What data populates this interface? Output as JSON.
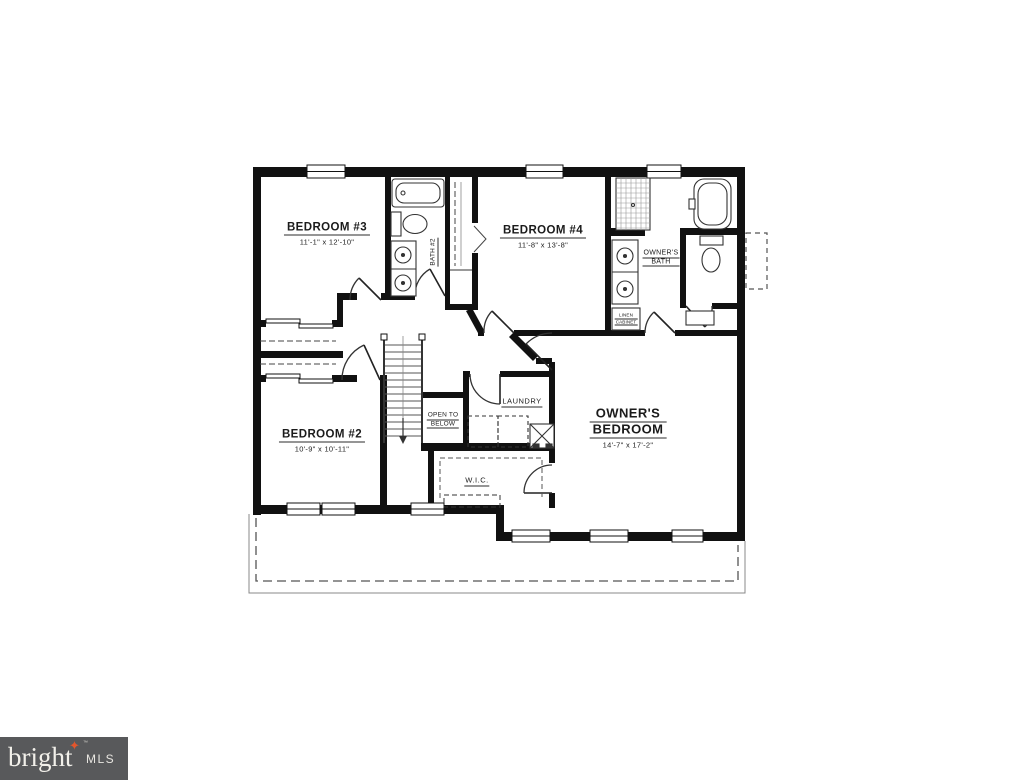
{
  "floorplan": {
    "rooms": [
      {
        "name": "BEDROOM #3",
        "dims": "11'-1\" x 12'-10\""
      },
      {
        "name": "BEDROOM #4",
        "dims": "11'-8\" x 13'-8\""
      },
      {
        "name": "BEDROOM #2",
        "dims": "10'-9\" x 10'-11\""
      },
      {
        "name_line1": "OWNER'S",
        "name_line2": "BEDROOM",
        "dims": "14'-7\" x 17'-2\""
      }
    ],
    "areas": {
      "bath2": "BATH #2",
      "owners_bath_line1": "OWNER'S",
      "owners_bath_line2": "BATH",
      "linen_line1": "LINEN",
      "linen_line2": "CABINET",
      "laundry": "LAUNDRY",
      "open_to_below_line1": "OPEN TO",
      "open_to_below_line2": "BELOW",
      "wic": "W.I.C."
    },
    "line_color": "#111111"
  },
  "logo": {
    "brand": "bright",
    "trademark": "™",
    "suffix": "MLS",
    "background": "#58595b",
    "text_color": "#f2f0ea",
    "accent_color": "#e2562d",
    "star_icon": "four-point-star"
  }
}
